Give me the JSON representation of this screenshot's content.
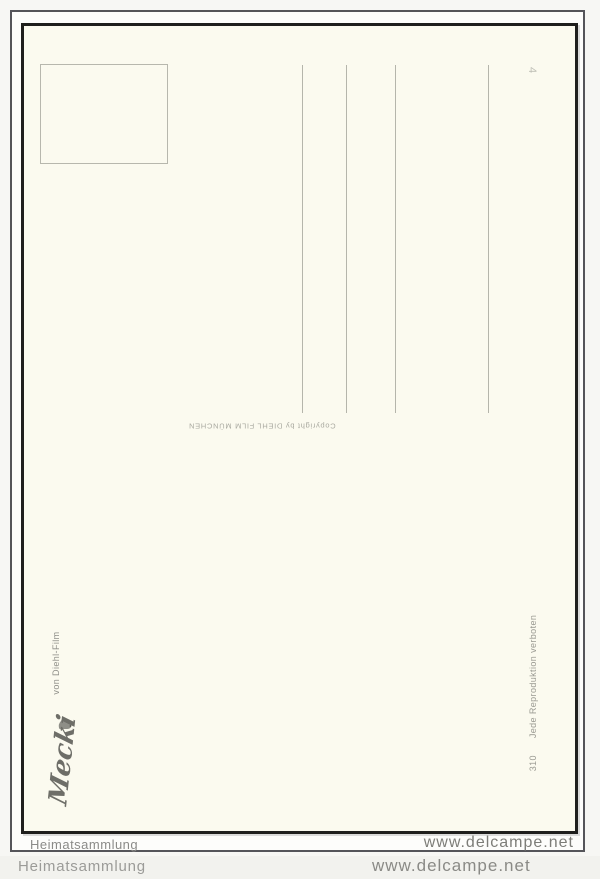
{
  "postcard": {
    "copyright_notice": "Copyright by DIEHL FILM MÜNCHEN",
    "publisher": "von Diehl-Film",
    "signature": "Mecki",
    "card_number": "310",
    "reproduction_notice": "Jede Reproduktion verboten",
    "series_mark": "4"
  },
  "watermark": {
    "collection": "Heimatsammlung",
    "site": "www.delcampe.net"
  },
  "colors": {
    "card_background": "#fbfaef",
    "card_border": "#1f1f1d",
    "address_line": "#b5b5ab",
    "watermark_text": "#8a8a86"
  }
}
